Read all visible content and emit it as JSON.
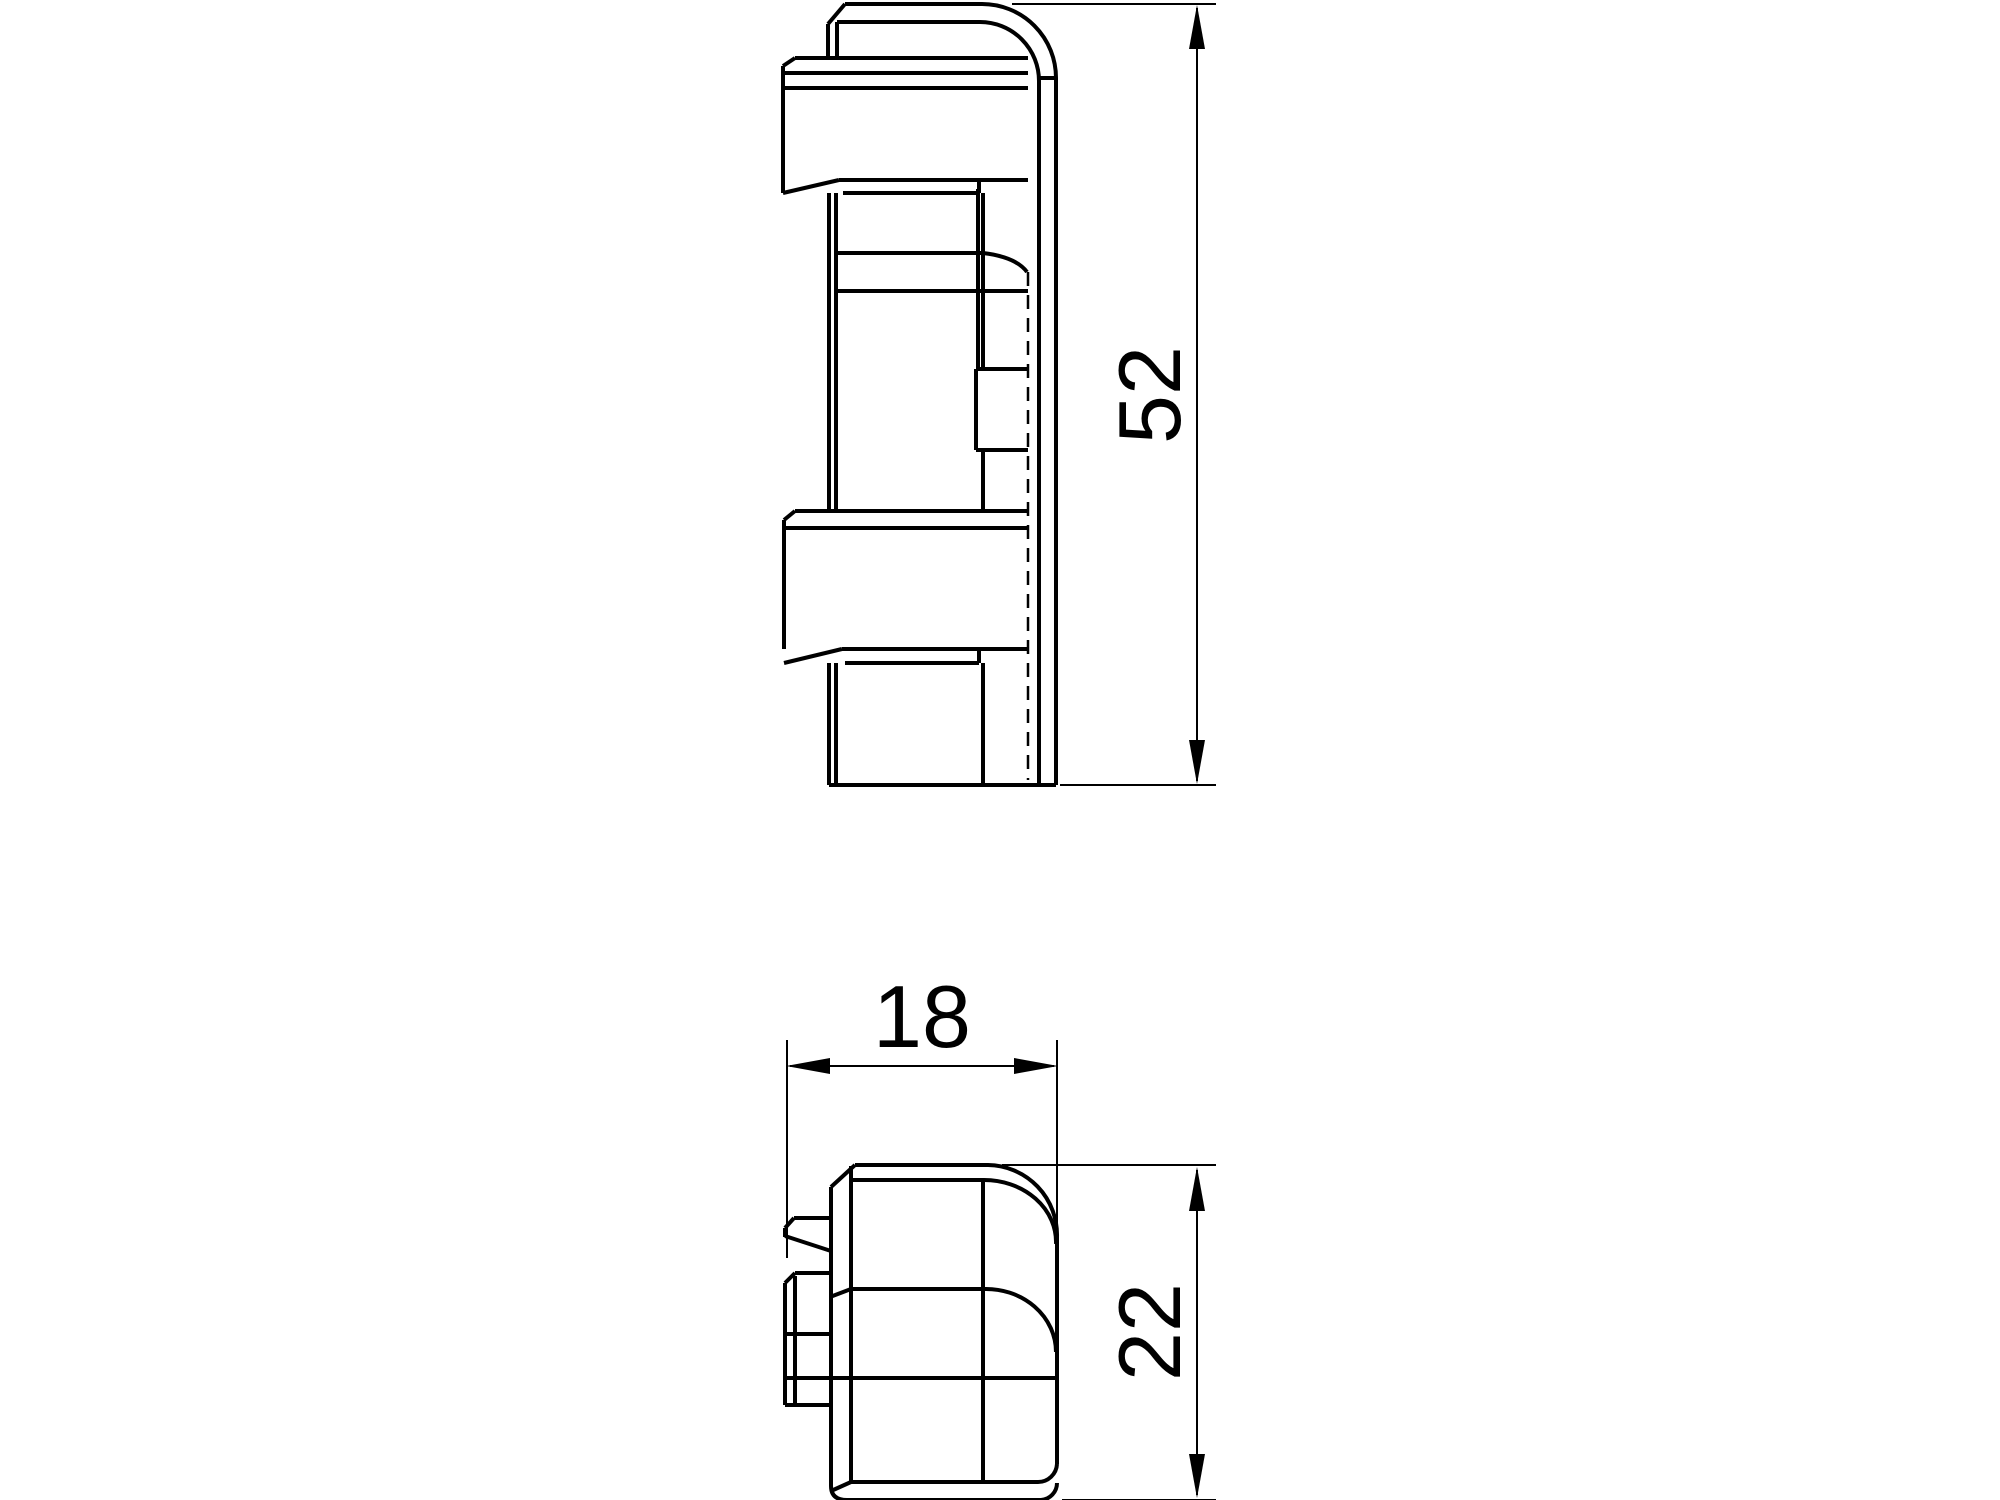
{
  "drawing": {
    "background": "#ffffff",
    "line_color": "#000000",
    "dimensions": {
      "side_height": {
        "label": "52"
      },
      "bottom_width": {
        "label": "18"
      },
      "bottom_height": {
        "label": "22"
      }
    }
  }
}
